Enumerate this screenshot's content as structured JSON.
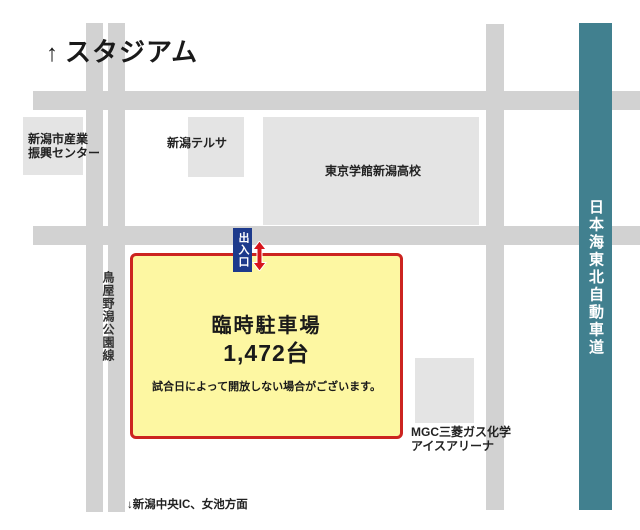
{
  "map": {
    "title_arrow": "↑",
    "title": "スタジアム",
    "buildings": {
      "industry_center": {
        "line1": "新潟市産業",
        "line2": "振興センター"
      },
      "terrsa": {
        "label": "新潟テルサ"
      },
      "high_school": {
        "label": "東京学館新潟高校"
      },
      "ice_arena": {
        "line1": "MGC三菱ガス化学",
        "line2": "アイスアリーナ"
      }
    },
    "roads": {
      "toyanogata_label": "鳥屋野潟公園線",
      "expressway_label": "日本海東北自動車道"
    },
    "parking": {
      "name": "臨時駐車場",
      "capacity": "1,472台",
      "note": "試合日によって開放しない場合がございます。"
    },
    "gate": {
      "label": "出入口"
    },
    "bottom_label": "↓新潟中央IC、女池方面",
    "colors": {
      "road": "#d2d2d2",
      "building": "#e4e4e4",
      "expressway": "#41808f",
      "parking_fill": "#fdf7a2",
      "parking_border": "#cc2420",
      "gate_badge_blue": "#1d3a8c",
      "arrow_red": "#d7151d"
    }
  }
}
